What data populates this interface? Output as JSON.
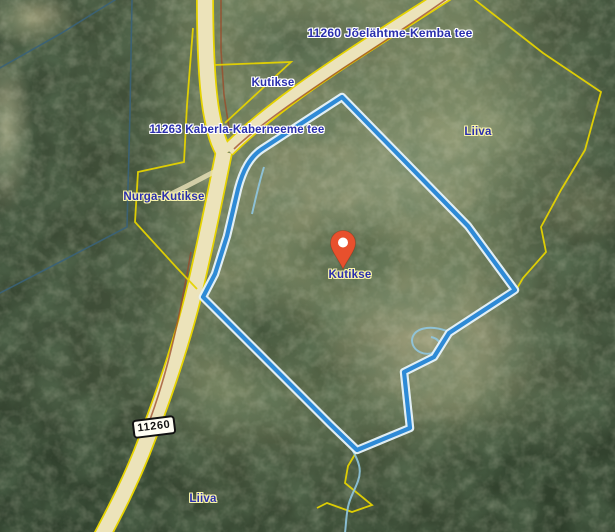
{
  "map": {
    "labels": {
      "road_top": "11260 Jõelähtme-Kemba tee",
      "parcel_top": "Kutikse",
      "road_west": "11263 Kaberla-Kaberneeme tee",
      "place_right": "Liiva",
      "place_west": "Nurga-Kutikse",
      "marker_place": "Kutikse",
      "place_bottom": "Liiva",
      "road_ref": "11260"
    },
    "colors": {
      "label_text": "#2a2fae",
      "halo_white": "#ffffff",
      "halo_yellow": "#f7f2a8",
      "selection_stroke": "#2e8ad6",
      "selection_casing": "#e8f4fc",
      "cadastral_yellow": "#e5d300",
      "boundary_teal": "#3a6278",
      "road_fill": "#ece3ba",
      "road_edge_red": "#9c4a28",
      "stream_blue": "#8fc6e0",
      "marker_fill": "#e8502d",
      "badge_bg": "#fffef4",
      "badge_border": "#111111",
      "badge_text": "#111111"
    }
  }
}
